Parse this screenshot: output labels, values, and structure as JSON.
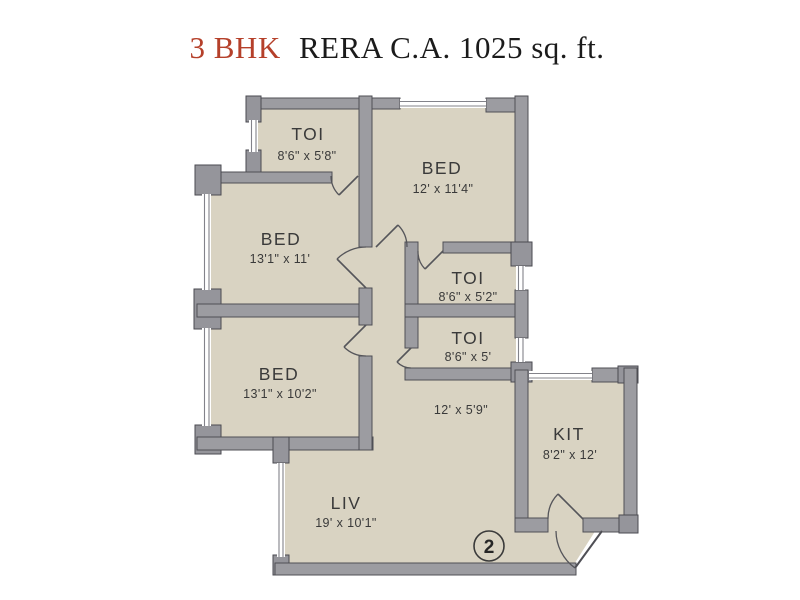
{
  "title": {
    "highlight": "3 BHK",
    "rest": "RERA C.A. 1025 sq. ft."
  },
  "rooms": {
    "toi1": {
      "name": "TOI",
      "dims": "8'6\" x 5'8\""
    },
    "bed1": {
      "name": "BED",
      "dims": "12' x 11'4\""
    },
    "bed2": {
      "name": "BED",
      "dims": "13'1\" x 11'"
    },
    "toi2": {
      "name": "TOI",
      "dims": "8'6\" x 5'2\""
    },
    "toi3": {
      "name": "TOI",
      "dims": "8'6\" x 5'"
    },
    "bed3": {
      "name": "BED",
      "dims": "13'1\" x 10'2\""
    },
    "passage": {
      "dims": "12' x 5'9\""
    },
    "kit": {
      "name": "KIT",
      "dims": "8'2\" x 12'"
    },
    "liv": {
      "name": "LIV",
      "dims": "19' x 10'1\""
    }
  },
  "unit_marker": "2",
  "colors": {
    "floor": "#d9d3c2",
    "wall": "#9c9ca1",
    "wall_outline": "#4f4f55",
    "title_accent": "#b5402a",
    "title_text": "#1b1b1b",
    "label_text": "#3a3a3a"
  }
}
